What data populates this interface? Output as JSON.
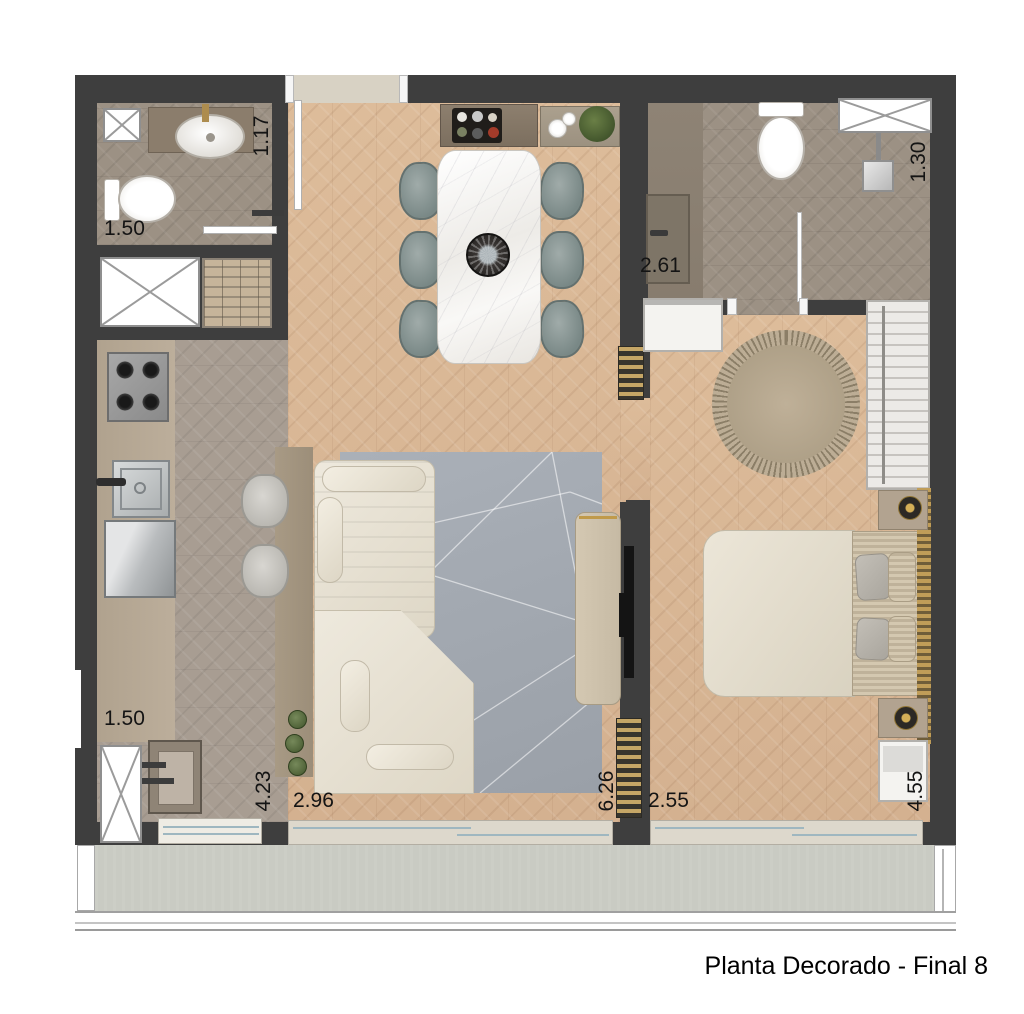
{
  "caption": "Planta Decorado - Final 8",
  "dimensions": {
    "bath1_width": "1.17",
    "bath1_length": "1.50",
    "hall_length": "2.61",
    "bath2_width": "1.30",
    "service_length": "1.50",
    "kitchen_length": "4.23",
    "living_width": "2.96",
    "living_length": "6.26",
    "bedroom_width": "2.55",
    "bedroom_length": "4.55"
  },
  "palette": {
    "wall": "#3e3e3e",
    "wood_floor": "#d9b795",
    "kitchen_tile": "#a89d92",
    "bath_tile": "#9c9184",
    "balcony_floor": "#c9cbc3",
    "rug": "#a3a9b1",
    "sofa": "#eae5d9",
    "chair": "#8a9695",
    "accent_gold": "#c09d58",
    "plant_green": "#4c5f33",
    "text": "#141414"
  }
}
